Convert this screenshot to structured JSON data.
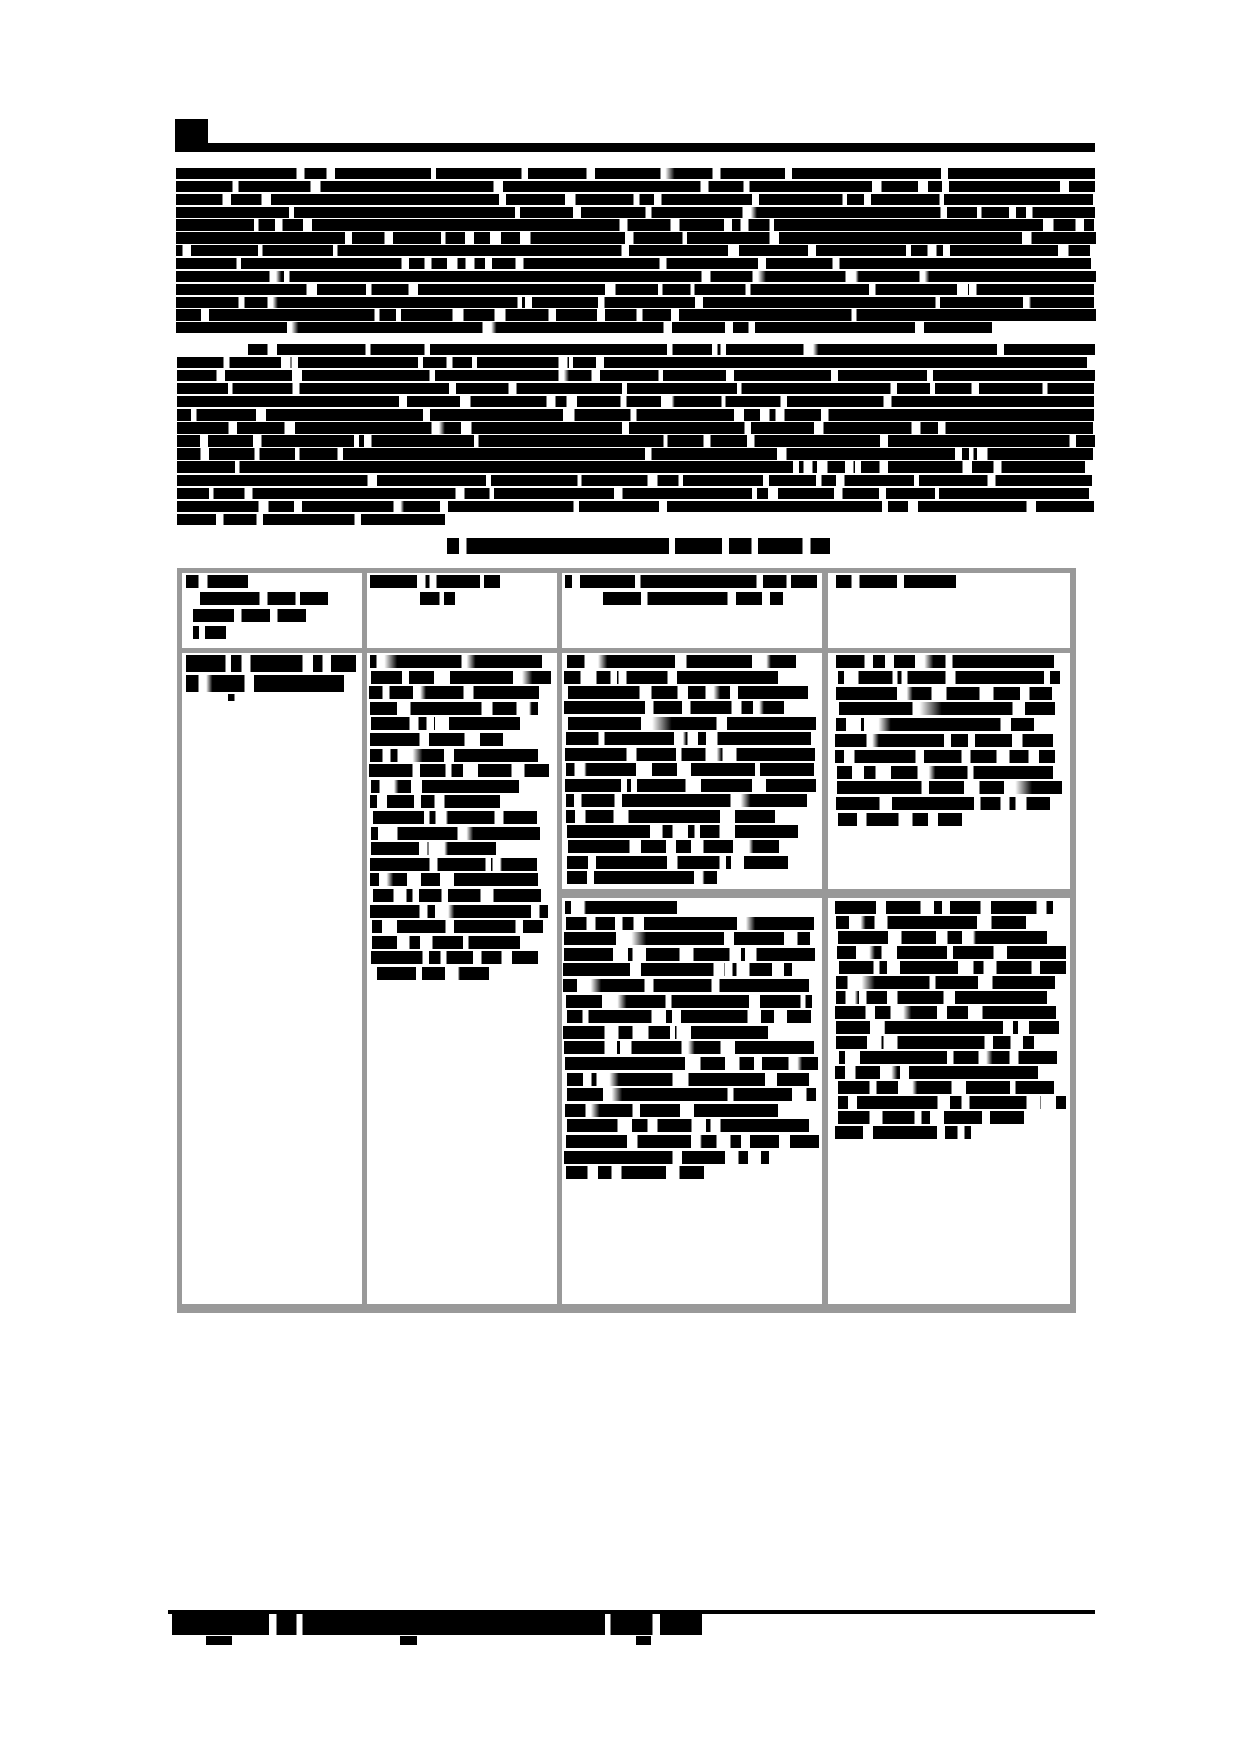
{
  "document": {
    "kind": "scanned-report-page",
    "note": "Binarized scan: every line of text is an illegible black redaction block. No legible characters are rendered anywhere on the page.",
    "colors": {
      "ink": "#000000",
      "paper": "#ffffff",
      "table_border": "#999999"
    }
  },
  "table": {
    "x": 177,
    "y": 568,
    "w": 899,
    "h": 745,
    "border_color": "#999999",
    "top": {
      "x": 177,
      "y": 568,
      "w": 899,
      "h": 5
    },
    "bottom": {
      "x": 177,
      "y": 1304,
      "w": 899,
      "h": 9
    },
    "left": {
      "x": 177,
      "y": 568,
      "w": 5,
      "h": 745
    },
    "right": {
      "x": 1070,
      "y": 568,
      "w": 6,
      "h": 745
    },
    "v1": {
      "x": 362,
      "y": 568,
      "w": 5,
      "h": 745
    },
    "v2": {
      "x": 557,
      "y": 568,
      "w": 5,
      "h": 745
    },
    "v3": {
      "x": 822,
      "y": 568,
      "w": 6,
      "h": 745
    },
    "header_divider": {
      "x": 177,
      "y": 648,
      "w": 899,
      "h": 5
    },
    "row_divider": {
      "x": 557,
      "y": 889,
      "w": 519,
      "h": 9
    }
  },
  "blocks": {
    "bullet_and_rule": {
      "segments": [
        [
          175,
          119,
          33,
          33
        ],
        [
          208,
          143,
          887,
          9
        ]
      ]
    },
    "para1": {
      "x": 176,
      "y": 168,
      "w": 920,
      "n": 13,
      "pitch": 12.85,
      "h": 11.3,
      "seed": 11,
      "gap_every": 95,
      "gap": [
        4,
        11
      ],
      "ragged": 8,
      "last_w": 816
    },
    "para2": {
      "x": 177,
      "y": 344,
      "w": 918,
      "n": 14,
      "pitch": 13.05,
      "h": 11.3,
      "seed": 22,
      "gap_every": 90,
      "gap": [
        4,
        11
      ],
      "ragged": 10,
      "first_indent": 71,
      "last_w": 268
    },
    "caption": {
      "x": 447,
      "y": 538,
      "w": 383,
      "n": 1,
      "pitch": 17,
      "h": 16,
      "seed": 33,
      "gap_every": 78,
      "gap": [
        5,
        9
      ],
      "ragged": 0
    },
    "th1": {
      "x": 186,
      "y": 575,
      "pitch": 17,
      "h": 13,
      "seed": 44,
      "gap_every": 52,
      "gap": [
        4,
        10
      ],
      "lines": [
        [
          0,
          62
        ],
        [
          14,
          128
        ],
        [
          7,
          113
        ],
        [
          7,
          33
        ]
      ]
    },
    "th2": {
      "x": 370,
      "y": 575,
      "pitch": 17,
      "h": 13,
      "seed": 45,
      "gap_every": 52,
      "gap": [
        4,
        10
      ],
      "lines": [
        [
          0,
          130
        ],
        [
          50,
          35
        ]
      ]
    },
    "th3": {
      "x": 565,
      "y": 575,
      "pitch": 17,
      "h": 13,
      "seed": 46,
      "gap_every": 60,
      "gap": [
        4,
        10
      ],
      "lines": [
        [
          0,
          252
        ],
        [
          38,
          180
        ]
      ]
    },
    "th4": {
      "x": 836,
      "y": 575,
      "pitch": 17,
      "h": 13,
      "seed": 47,
      "gap_every": 52,
      "gap": [
        4,
        10
      ],
      "lines": [
        [
          0,
          120
        ]
      ]
    },
    "c1r1": {
      "x": 186,
      "y": 655,
      "pitch": 19.5,
      "h": 17,
      "seed": 55,
      "gap_every": 46,
      "gap": [
        5,
        13
      ],
      "lines": [
        [
          0,
          170,
          17
        ],
        [
          0,
          158,
          17
        ],
        [
          42,
          16,
          7
        ]
      ]
    },
    "c2": {
      "x": 370,
      "y": 655,
      "w": 180,
      "n": 21,
      "pitch": 15.6,
      "h": 13,
      "seed": 66,
      "gap_every": 44,
      "gap": [
        5,
        16
      ],
      "ragged": 55,
      "jitter": 5,
      "last_w": 112,
      "last_x": 7
    },
    "c3r1": {
      "x": 565,
      "y": 655,
      "w": 252,
      "n": 15,
      "pitch": 15.45,
      "h": 13,
      "seed": 77,
      "gap_every": 46,
      "gap": [
        5,
        16
      ],
      "ragged": 55,
      "jitter": 5,
      "last_w": 150
    },
    "c4r1": {
      "x": 836,
      "y": 655,
      "w": 228,
      "n": 11,
      "pitch": 15.8,
      "h": 13,
      "seed": 88,
      "gap_every": 46,
      "gap": [
        5,
        16
      ],
      "ragged": 50,
      "jitter": 5,
      "last_w": 124
    },
    "c3r2": {
      "x": 564,
      "y": 901,
      "w": 254,
      "n": 18,
      "pitch": 15.6,
      "h": 13,
      "seed": 99,
      "gap_every": 46,
      "gap": [
        5,
        16
      ],
      "ragged": 55,
      "jitter": 5,
      "first_w": 112,
      "last_w": 138
    },
    "c4r2": {
      "x": 836,
      "y": 901,
      "w": 230,
      "n": 16,
      "pitch": 15.0,
      "h": 13,
      "seed": 111,
      "gap_every": 46,
      "gap": [
        5,
        16
      ],
      "ragged": 50,
      "jitter": 5,
      "last_w": 136
    },
    "footer_rule": {
      "segments": [
        [
          168,
          1610,
          927,
          4
        ]
      ]
    },
    "footer_bar": {
      "x": 172,
      "y": 1614,
      "w": 530,
      "n": 1,
      "pitch": 22,
      "h": 21,
      "seed": 123,
      "gap_every": 120,
      "gap": [
        4,
        8
      ],
      "ragged": 0
    },
    "footer_marks": {
      "segments": [
        [
          206,
          1636,
          26,
          9
        ],
        [
          400,
          1636,
          17,
          9
        ],
        [
          636,
          1636,
          15,
          9
        ]
      ]
    }
  }
}
